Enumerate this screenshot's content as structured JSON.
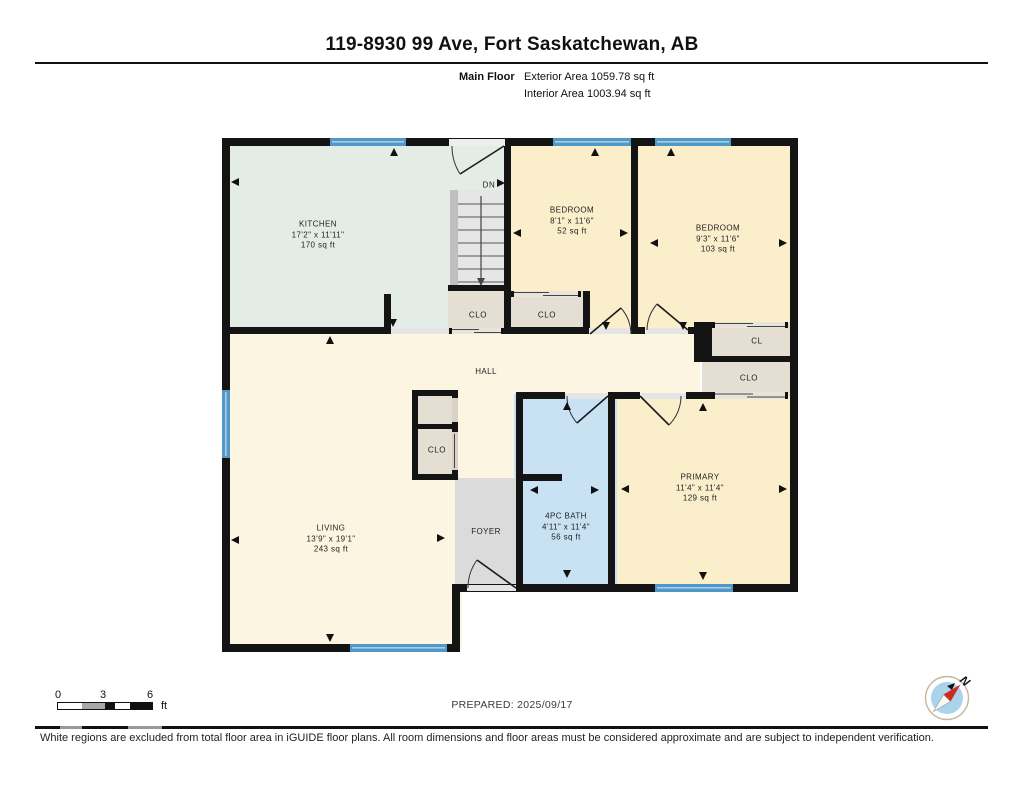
{
  "header": {
    "title": "119-8930 99 Ave, Fort Saskatchewan, AB",
    "floor_label": "Main Floor",
    "exterior_area": "Exterior Area 1059.78 sq ft",
    "interior_area": "Interior Area 1003.94 sq ft"
  },
  "rooms": [
    {
      "name": "KITCHEN",
      "dims": "17'2\" x 11'11\"",
      "area": "170 sq ft"
    },
    {
      "name": "BEDROOM",
      "dims": "8'1\" x 11'6\"",
      "area": "52 sq ft"
    },
    {
      "name": "BEDROOM",
      "dims": "9'3\" x 11'6\"",
      "area": "103 sq ft"
    },
    {
      "name": "HALL"
    },
    {
      "name": "PRIMARY",
      "dims": "11'4\" x 11'4\"",
      "area": "129 sq ft"
    },
    {
      "name": "4PC BATH",
      "dims": "4'11\" x 11'4\"",
      "area": "56 sq ft"
    },
    {
      "name": "LIVING",
      "dims": "13'9\" x 19'1\"",
      "area": "243 sq ft"
    },
    {
      "name": "FOYER"
    }
  ],
  "labels": {
    "clo": "CLO",
    "cl": "CL",
    "dn": "DN"
  },
  "scale": {
    "t0": "0",
    "t3": "3",
    "t6": "6",
    "unit": "ft"
  },
  "footer": {
    "prepared": "PREPARED: 2025/09/17",
    "north_label": "N",
    "disclaimer": "White regions are excluded from total floor area in iGUIDE floor plans. All room dimensions and floor areas must be considered approximate and are subject to independent verification."
  },
  "colors": {
    "wall": "#141414",
    "kitchen": "#E3EDE5",
    "bedroom": "#FAEECB",
    "living_hall": "#FCF5E1",
    "bath": "#C8E2F4",
    "closet": "#E4DED3",
    "foyer_stairs": "#DBDBDB",
    "window": "#4F98C7",
    "compass_face": "#A9D4EA",
    "compass_needle": "#CE2A21"
  }
}
